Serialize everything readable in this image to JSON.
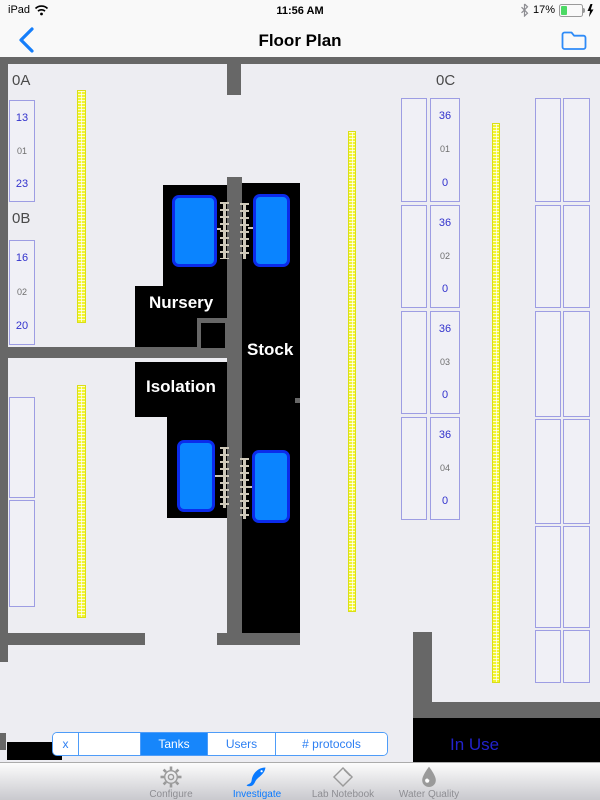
{
  "status_bar": {
    "device": "iPad",
    "time": "11:56 AM",
    "battery_percent": "17%"
  },
  "nav_bar": {
    "title": "Floor Plan"
  },
  "floor_plan": {
    "area_labels": [
      {
        "text": "0A",
        "x": 12,
        "y": 72
      },
      {
        "text": "0B",
        "x": 12,
        "y": 210
      },
      {
        "text": "0C",
        "x": 436,
        "y": 72
      }
    ],
    "room_labels": [
      {
        "text": "Nursery",
        "x": 149,
        "y": 293
      },
      {
        "text": "Stock",
        "x": 247,
        "y": 340
      },
      {
        "text": "Isolation",
        "x": 146,
        "y": 377
      }
    ],
    "in_use_label": "In Use",
    "racks": [
      {
        "x": 9,
        "y": 100,
        "w": 26,
        "h": 102,
        "cells": [
          {
            "text": "13",
            "color": "b"
          },
          {
            "text": "01",
            "color": "g"
          },
          {
            "text": "23",
            "color": "b"
          }
        ]
      },
      {
        "x": 9,
        "y": 240,
        "w": 26,
        "h": 105,
        "cells": [
          {
            "text": "16",
            "color": "b"
          },
          {
            "text": "02",
            "color": "g"
          },
          {
            "text": "20",
            "color": "b"
          }
        ]
      },
      {
        "x": 9,
        "y": 397,
        "w": 26,
        "h": 101,
        "cells": []
      },
      {
        "x": 9,
        "y": 500,
        "w": 26,
        "h": 107,
        "cells": []
      },
      {
        "x": 401,
        "y": 98,
        "w": 26,
        "h": 104,
        "cells": []
      },
      {
        "x": 430,
        "y": 98,
        "w": 30,
        "h": 104,
        "cells": [
          {
            "text": "36",
            "color": "b"
          },
          {
            "text": "01",
            "color": "g"
          },
          {
            "text": "0",
            "color": "b"
          }
        ]
      },
      {
        "x": 401,
        "y": 205,
        "w": 26,
        "h": 103,
        "cells": []
      },
      {
        "x": 430,
        "y": 205,
        "w": 30,
        "h": 103,
        "cells": [
          {
            "text": "36",
            "color": "b"
          },
          {
            "text": "02",
            "color": "g"
          },
          {
            "text": "0",
            "color": "b"
          }
        ]
      },
      {
        "x": 401,
        "y": 311,
        "w": 26,
        "h": 103,
        "cells": []
      },
      {
        "x": 430,
        "y": 311,
        "w": 30,
        "h": 103,
        "cells": [
          {
            "text": "36",
            "color": "b"
          },
          {
            "text": "03",
            "color": "g"
          },
          {
            "text": "0",
            "color": "b"
          }
        ]
      },
      {
        "x": 401,
        "y": 417,
        "w": 26,
        "h": 103,
        "cells": []
      },
      {
        "x": 430,
        "y": 417,
        "w": 30,
        "h": 103,
        "cells": [
          {
            "text": "36",
            "color": "b"
          },
          {
            "text": "04",
            "color": "g"
          },
          {
            "text": "0",
            "color": "b"
          }
        ]
      },
      {
        "x": 535,
        "y": 98,
        "w": 26,
        "h": 104,
        "cells": []
      },
      {
        "x": 563,
        "y": 98,
        "w": 27,
        "h": 104,
        "cells": []
      },
      {
        "x": 535,
        "y": 205,
        "w": 26,
        "h": 103,
        "cells": []
      },
      {
        "x": 563,
        "y": 205,
        "w": 27,
        "h": 103,
        "cells": []
      },
      {
        "x": 535,
        "y": 311,
        "w": 26,
        "h": 106,
        "cells": []
      },
      {
        "x": 563,
        "y": 311,
        "w": 27,
        "h": 106,
        "cells": []
      },
      {
        "x": 535,
        "y": 419,
        "w": 26,
        "h": 105,
        "cells": []
      },
      {
        "x": 563,
        "y": 419,
        "w": 27,
        "h": 105,
        "cells": []
      },
      {
        "x": 535,
        "y": 526,
        "w": 26,
        "h": 102,
        "cells": []
      },
      {
        "x": 563,
        "y": 526,
        "w": 27,
        "h": 102,
        "cells": []
      },
      {
        "x": 535,
        "y": 630,
        "w": 26,
        "h": 53,
        "cells": []
      },
      {
        "x": 563,
        "y": 630,
        "w": 27,
        "h": 53,
        "cells": []
      }
    ],
    "shelves": [
      {
        "x": 77,
        "y": 90,
        "w": 9,
        "h": 233
      },
      {
        "x": 77,
        "y": 385,
        "w": 9,
        "h": 233
      },
      {
        "x": 348,
        "y": 131,
        "w": 8,
        "h": 481
      },
      {
        "x": 492,
        "y": 123,
        "w": 8,
        "h": 560
      }
    ],
    "tanks": [
      {
        "x": 172,
        "y": 195,
        "w": 45,
        "h": 72
      },
      {
        "x": 253,
        "y": 194,
        "w": 37,
        "h": 73
      },
      {
        "x": 177,
        "y": 440,
        "w": 38,
        "h": 72
      },
      {
        "x": 252,
        "y": 450,
        "w": 38,
        "h": 73
      }
    ],
    "colors": {
      "wall": "#676767",
      "tank_fill": "#0A84FF",
      "tank_border": "#0B2BEB",
      "shelf_yellow": "#F2F52F",
      "rack_border": "#9D9DE3",
      "rack_text_blue": "#3232CD",
      "in_use_text": "#2222CC",
      "accent_blue": "#157EFA",
      "battery_green": "#4CD964"
    }
  },
  "filter_bar": {
    "segments": [
      {
        "label": "x",
        "width": 26,
        "selected": false
      },
      {
        "label": "",
        "width": 62,
        "selected": false
      },
      {
        "label": "Tanks",
        "width": 67,
        "selected": true
      },
      {
        "label": "Users",
        "width": 68,
        "selected": false
      },
      {
        "label": "# protocols",
        "width": 111,
        "selected": false
      }
    ]
  },
  "tab_bar": {
    "items": [
      {
        "label": "Configure",
        "icon": "gear-icon",
        "selected": false
      },
      {
        "label": "Investigate",
        "icon": "fish-icon",
        "selected": true
      },
      {
        "label": "Lab Notebook",
        "icon": "notebook-icon",
        "selected": false
      },
      {
        "label": "Water Quality",
        "icon": "droplet-icon",
        "selected": false
      }
    ]
  }
}
